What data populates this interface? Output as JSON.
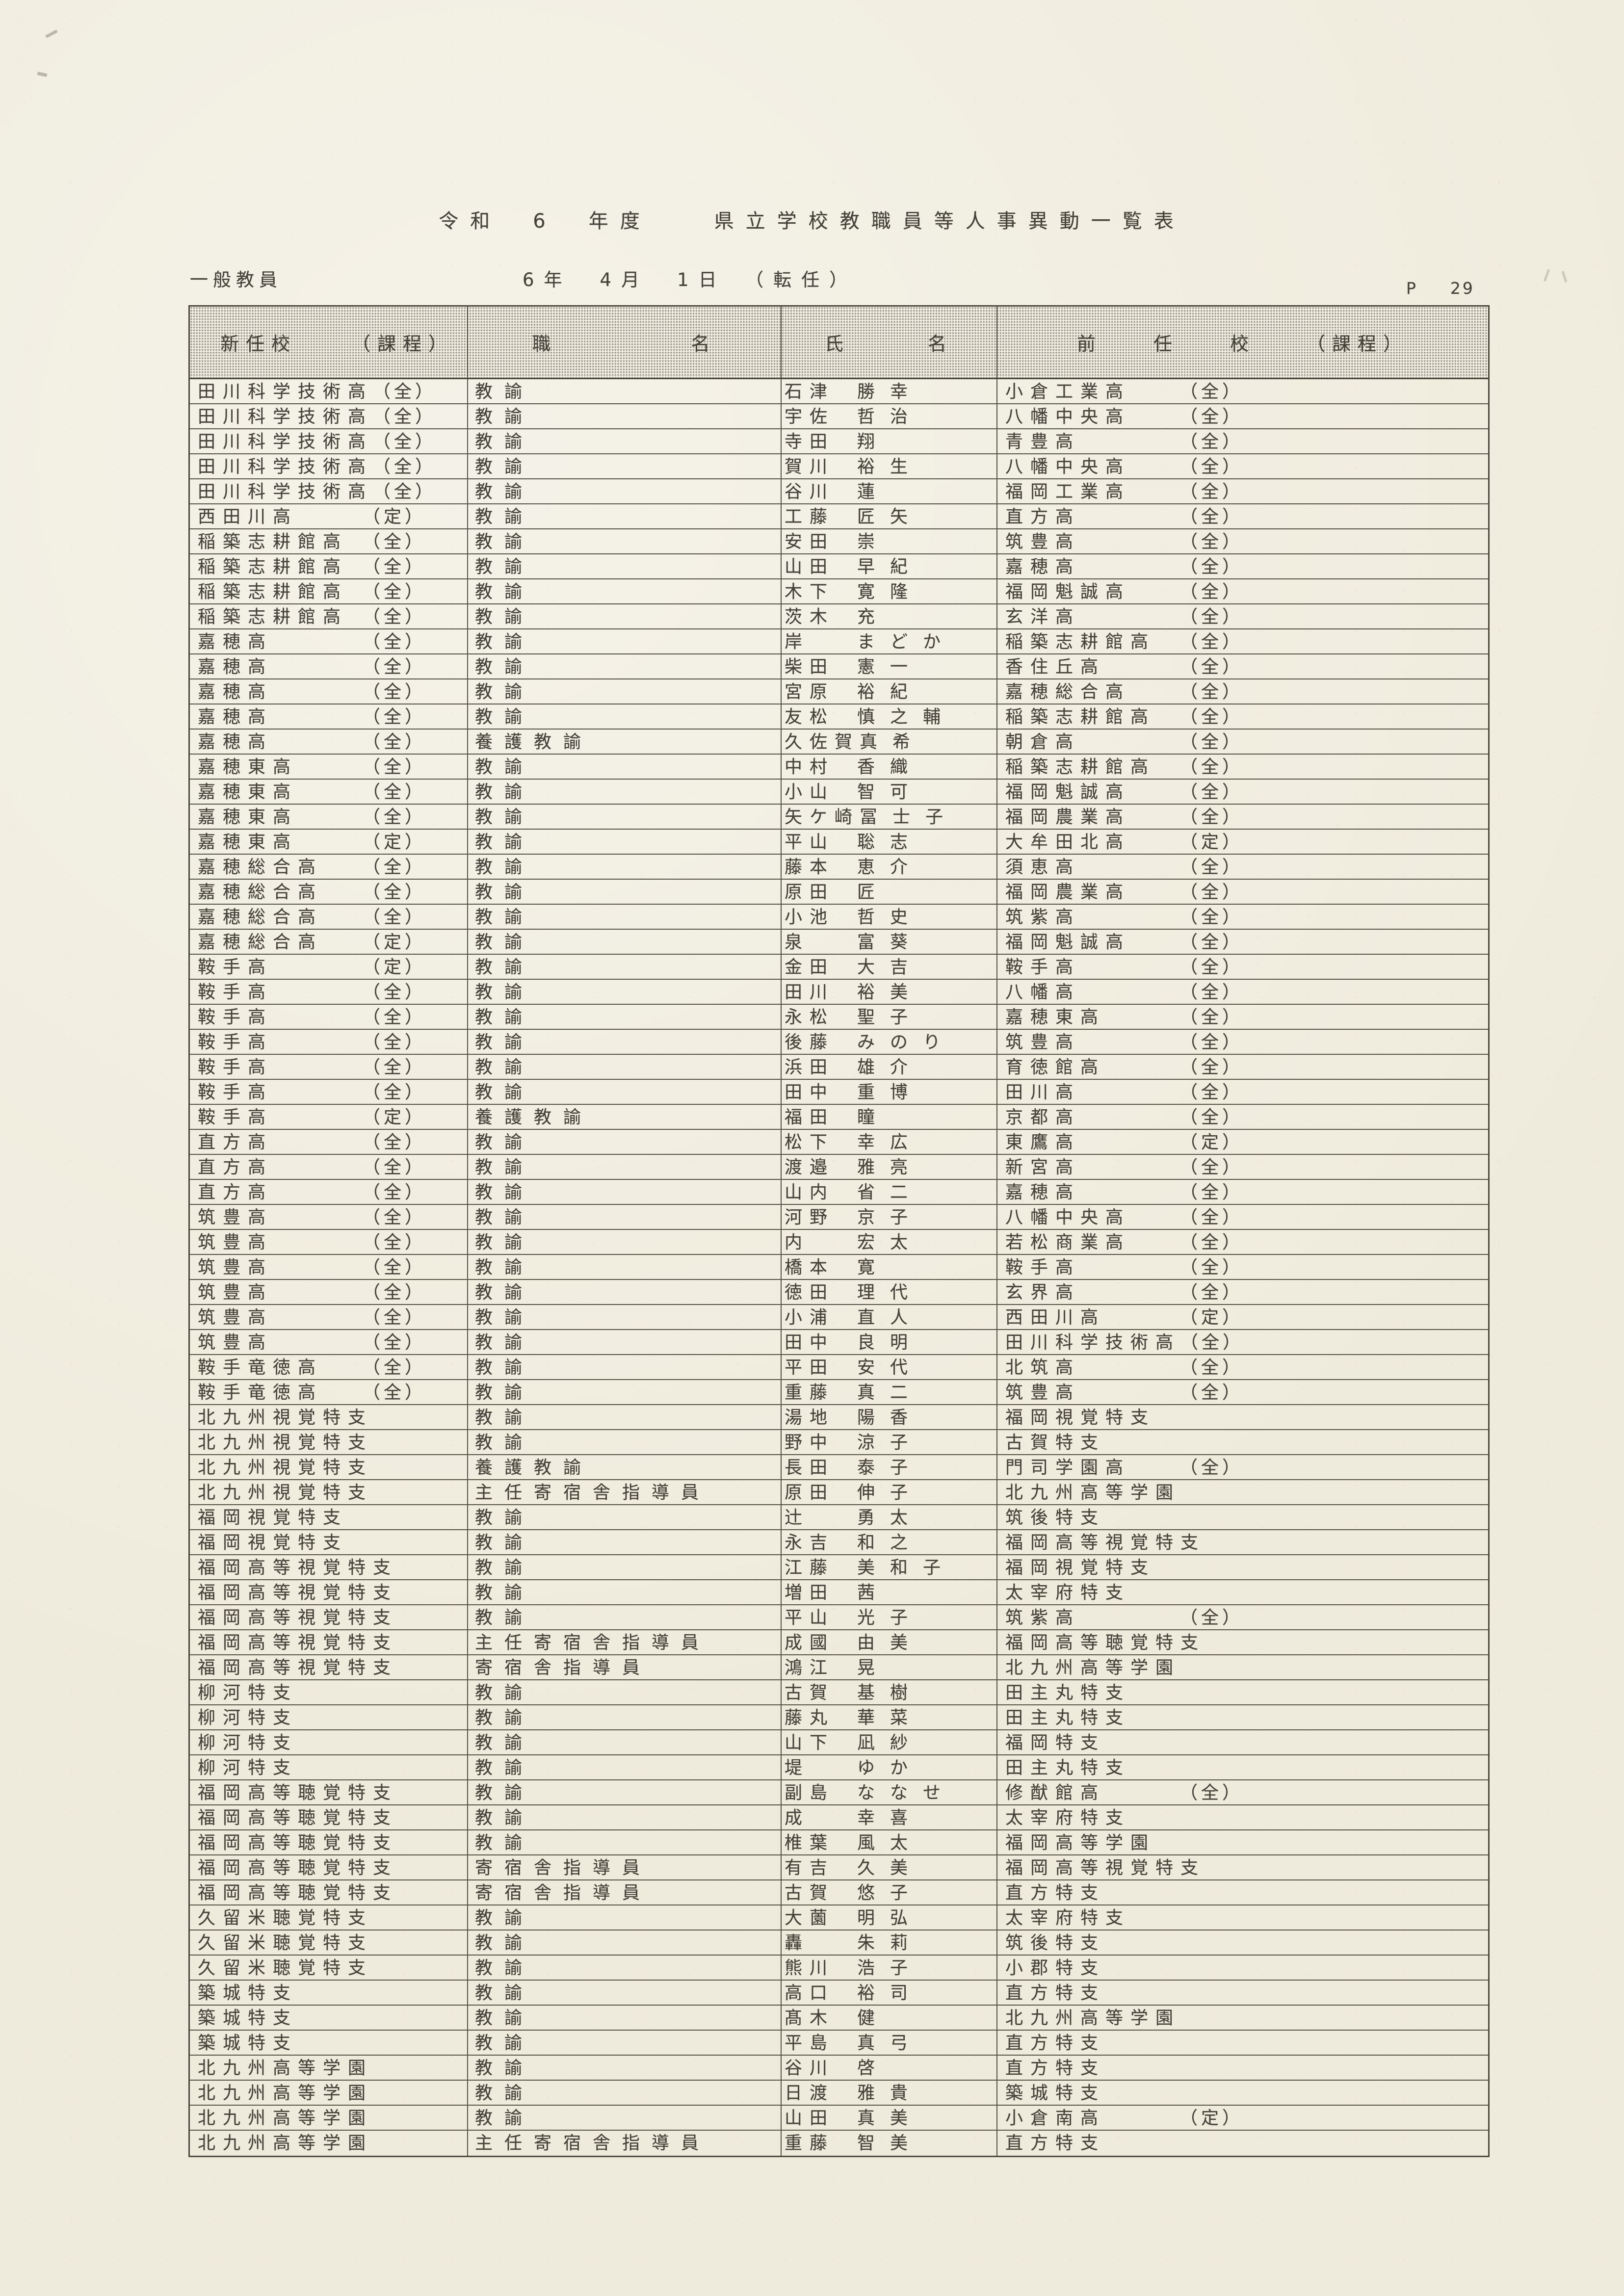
{
  "page": {
    "title": "令和　6　年度　　県立学校教職員等人事異動一覧表",
    "category_label": "一般教員",
    "date_line": "6年　4月　1日　（転任）",
    "page_marker": {
      "label": "P",
      "number": "29"
    }
  },
  "table": {
    "headers": {
      "col1": [
        "新任校",
        "（課程）"
      ],
      "col2": [
        "職",
        "名"
      ],
      "col3": [
        "氏",
        "名"
      ],
      "col4": [
        "前",
        "任",
        "校",
        "（課程）"
      ]
    },
    "rows": [
      {
        "school": "田川科学技術高",
        "course": "（全）",
        "position": "教諭",
        "name": "石津　勝幸",
        "prev_school": "小倉工業高",
        "prev_course": "（全）"
      },
      {
        "school": "田川科学技術高",
        "course": "（全）",
        "position": "教諭",
        "name": "宇佐　哲治",
        "prev_school": "八幡中央高",
        "prev_course": "（全）"
      },
      {
        "school": "田川科学技術高",
        "course": "（全）",
        "position": "教諭",
        "name": "寺田　翔",
        "prev_school": "青豊高",
        "prev_course": "（全）"
      },
      {
        "school": "田川科学技術高",
        "course": "（全）",
        "position": "教諭",
        "name": "賀川　裕生",
        "prev_school": "八幡中央高",
        "prev_course": "（全）"
      },
      {
        "school": "田川科学技術高",
        "course": "（全）",
        "position": "教諭",
        "name": "谷川　蓮",
        "prev_school": "福岡工業高",
        "prev_course": "（全）"
      },
      {
        "school": "西田川高",
        "course": "（定）",
        "position": "教諭",
        "name": "工藤　匠矢",
        "prev_school": "直方高",
        "prev_course": "（全）"
      },
      {
        "school": "稲築志耕館高",
        "course": "（全）",
        "position": "教諭",
        "name": "安田　崇",
        "prev_school": "筑豊高",
        "prev_course": "（全）"
      },
      {
        "school": "稲築志耕館高",
        "course": "（全）",
        "position": "教諭",
        "name": "山田　早紀",
        "prev_school": "嘉穂高",
        "prev_course": "（全）"
      },
      {
        "school": "稲築志耕館高",
        "course": "（全）",
        "position": "教諭",
        "name": "木下　寛隆",
        "prev_school": "福岡魁誠高",
        "prev_course": "（全）"
      },
      {
        "school": "稲築志耕館高",
        "course": "（全）",
        "position": "教諭",
        "name": "茨木　充",
        "prev_school": "玄洋高",
        "prev_course": "（全）"
      },
      {
        "school": "嘉穂高",
        "course": "（全）",
        "position": "教諭",
        "name": "岸　まどか",
        "prev_school": "稲築志耕館高",
        "prev_course": "（全）"
      },
      {
        "school": "嘉穂高",
        "course": "（全）",
        "position": "教諭",
        "name": "柴田　憲一",
        "prev_school": "香住丘高",
        "prev_course": "（全）"
      },
      {
        "school": "嘉穂高",
        "course": "（全）",
        "position": "教諭",
        "name": "宮原　裕紀",
        "prev_school": "嘉穂総合高",
        "prev_course": "（全）"
      },
      {
        "school": "嘉穂高",
        "course": "（全）",
        "position": "教諭",
        "name": "友松　慎之輔",
        "prev_school": "稲築志耕館高",
        "prev_course": "（全）"
      },
      {
        "school": "嘉穂高",
        "course": "（全）",
        "position": "養護教諭",
        "name": "久佐賀　真希",
        "prev_school": "朝倉高",
        "prev_course": "（全）"
      },
      {
        "school": "嘉穂東高",
        "course": "（全）",
        "position": "教諭",
        "name": "中村　香織",
        "prev_school": "稲築志耕館高",
        "prev_course": "（全）"
      },
      {
        "school": "嘉穂東高",
        "course": "（全）",
        "position": "教諭",
        "name": "小山　智可",
        "prev_school": "福岡魁誠高",
        "prev_course": "（全）"
      },
      {
        "school": "嘉穂東高",
        "course": "（全）",
        "position": "教諭",
        "name": "矢ケ崎　冨士子",
        "prev_school": "福岡農業高",
        "prev_course": "（全）"
      },
      {
        "school": "嘉穂東高",
        "course": "（定）",
        "position": "教諭",
        "name": "平山　聡志",
        "prev_school": "大牟田北高",
        "prev_course": "（定）"
      },
      {
        "school": "嘉穂総合高",
        "course": "（全）",
        "position": "教諭",
        "name": "藤本　恵介",
        "prev_school": "須恵高",
        "prev_course": "（全）"
      },
      {
        "school": "嘉穂総合高",
        "course": "（全）",
        "position": "教諭",
        "name": "原田　匠",
        "prev_school": "福岡農業高",
        "prev_course": "（全）"
      },
      {
        "school": "嘉穂総合高",
        "course": "（全）",
        "position": "教諭",
        "name": "小池　哲史",
        "prev_school": "筑紫高",
        "prev_course": "（全）"
      },
      {
        "school": "嘉穂総合高",
        "course": "（定）",
        "position": "教諭",
        "name": "泉　富葵",
        "prev_school": "福岡魁誠高",
        "prev_course": "（全）"
      },
      {
        "school": "鞍手高",
        "course": "（定）",
        "position": "教諭",
        "name": "金田　大吉",
        "prev_school": "鞍手高",
        "prev_course": "（全）"
      },
      {
        "school": "鞍手高",
        "course": "（全）",
        "position": "教諭",
        "name": "田川　裕美",
        "prev_school": "八幡高",
        "prev_course": "（全）"
      },
      {
        "school": "鞍手高",
        "course": "（全）",
        "position": "教諭",
        "name": "永松　聖子",
        "prev_school": "嘉穂東高",
        "prev_course": "（全）"
      },
      {
        "school": "鞍手高",
        "course": "（全）",
        "position": "教諭",
        "name": "後藤　みのり",
        "prev_school": "筑豊高",
        "prev_course": "（全）"
      },
      {
        "school": "鞍手高",
        "course": "（全）",
        "position": "教諭",
        "name": "浜田　雄介",
        "prev_school": "育徳館高",
        "prev_course": "（全）"
      },
      {
        "school": "鞍手高",
        "course": "（全）",
        "position": "教諭",
        "name": "田中　重博",
        "prev_school": "田川高",
        "prev_course": "（全）"
      },
      {
        "school": "鞍手高",
        "course": "（定）",
        "position": "養護教諭",
        "name": "福田　瞳",
        "prev_school": "京都高",
        "prev_course": "（全）"
      },
      {
        "school": "直方高",
        "course": "（全）",
        "position": "教諭",
        "name": "松下　幸広",
        "prev_school": "東鷹高",
        "prev_course": "（定）"
      },
      {
        "school": "直方高",
        "course": "（全）",
        "position": "教諭",
        "name": "渡邉　雅亮",
        "prev_school": "新宮高",
        "prev_course": "（全）"
      },
      {
        "school": "直方高",
        "course": "（全）",
        "position": "教諭",
        "name": "山内　省二",
        "prev_school": "嘉穂高",
        "prev_course": "（全）"
      },
      {
        "school": "筑豊高",
        "course": "（全）",
        "position": "教諭",
        "name": "河野　京子",
        "prev_school": "八幡中央高",
        "prev_course": "（全）"
      },
      {
        "school": "筑豊高",
        "course": "（全）",
        "position": "教諭",
        "name": "内　宏太",
        "prev_school": "若松商業高",
        "prev_course": "（全）"
      },
      {
        "school": "筑豊高",
        "course": "（全）",
        "position": "教諭",
        "name": "橋本　寛",
        "prev_school": "鞍手高",
        "prev_course": "（全）"
      },
      {
        "school": "筑豊高",
        "course": "（全）",
        "position": "教諭",
        "name": "徳田　理代",
        "prev_school": "玄界高",
        "prev_course": "（全）"
      },
      {
        "school": "筑豊高",
        "course": "（全）",
        "position": "教諭",
        "name": "小浦　直人",
        "prev_school": "西田川高",
        "prev_course": "（定）"
      },
      {
        "school": "筑豊高",
        "course": "（全）",
        "position": "教諭",
        "name": "田中　良明",
        "prev_school": "田川科学技術高",
        "prev_course": "（全）"
      },
      {
        "school": "鞍手竜徳高",
        "course": "（全）",
        "position": "教諭",
        "name": "平田　安代",
        "prev_school": "北筑高",
        "prev_course": "（全）"
      },
      {
        "school": "鞍手竜徳高",
        "course": "（全）",
        "position": "教諭",
        "name": "重藤　真二",
        "prev_school": "筑豊高",
        "prev_course": "（全）"
      },
      {
        "school": "北九州視覚特支",
        "course": "",
        "position": "教諭",
        "name": "湯地　陽香",
        "prev_school": "福岡視覚特支",
        "prev_course": ""
      },
      {
        "school": "北九州視覚特支",
        "course": "",
        "position": "教諭",
        "name": "野中　涼子",
        "prev_school": "古賀特支",
        "prev_course": ""
      },
      {
        "school": "北九州視覚特支",
        "course": "",
        "position": "養護教諭",
        "name": "長田　泰子",
        "prev_school": "門司学園高",
        "prev_course": "（全）"
      },
      {
        "school": "北九州視覚特支",
        "course": "",
        "position": "主任寄宿舎指導員",
        "name": "原田　伸子",
        "prev_school": "北九州高等学園",
        "prev_course": ""
      },
      {
        "school": "福岡視覚特支",
        "course": "",
        "position": "教諭",
        "name": "辻　勇太",
        "prev_school": "筑後特支",
        "prev_course": ""
      },
      {
        "school": "福岡視覚特支",
        "course": "",
        "position": "教諭",
        "name": "永吉　和之",
        "prev_school": "福岡高等視覚特支",
        "prev_course": ""
      },
      {
        "school": "福岡高等視覚特支",
        "course": "",
        "position": "教諭",
        "name": "江藤　美和子",
        "prev_school": "福岡視覚特支",
        "prev_course": ""
      },
      {
        "school": "福岡高等視覚特支",
        "course": "",
        "position": "教諭",
        "name": "増田　茜",
        "prev_school": "太宰府特支",
        "prev_course": ""
      },
      {
        "school": "福岡高等視覚特支",
        "course": "",
        "position": "教諭",
        "name": "平山　光子",
        "prev_school": "筑紫高",
        "prev_course": "（全）"
      },
      {
        "school": "福岡高等視覚特支",
        "course": "",
        "position": "主任寄宿舎指導員",
        "name": "成國　由美",
        "prev_school": "福岡高等聴覚特支",
        "prev_course": ""
      },
      {
        "school": "福岡高等視覚特支",
        "course": "",
        "position": "寄宿舎指導員",
        "name": "鴻江　晃",
        "prev_school": "北九州高等学園",
        "prev_course": ""
      },
      {
        "school": "柳河特支",
        "course": "",
        "position": "教諭",
        "name": "古賀　基樹",
        "prev_school": "田主丸特支",
        "prev_course": ""
      },
      {
        "school": "柳河特支",
        "course": "",
        "position": "教諭",
        "name": "藤丸　華菜",
        "prev_school": "田主丸特支",
        "prev_course": ""
      },
      {
        "school": "柳河特支",
        "course": "",
        "position": "教諭",
        "name": "山下　凪紗",
        "prev_school": "福岡特支",
        "prev_course": ""
      },
      {
        "school": "柳河特支",
        "course": "",
        "position": "教諭",
        "name": "堤　ゆか",
        "prev_school": "田主丸特支",
        "prev_course": ""
      },
      {
        "school": "福岡高等聴覚特支",
        "course": "",
        "position": "教諭",
        "name": "副島　ななせ",
        "prev_school": "修猷館高",
        "prev_course": "（全）"
      },
      {
        "school": "福岡高等聴覚特支",
        "course": "",
        "position": "教諭",
        "name": "成　幸喜",
        "prev_school": "太宰府特支",
        "prev_course": ""
      },
      {
        "school": "福岡高等聴覚特支",
        "course": "",
        "position": "教諭",
        "name": "椎葉　風太",
        "prev_school": "福岡高等学園",
        "prev_course": ""
      },
      {
        "school": "福岡高等聴覚特支",
        "course": "",
        "position": "寄宿舎指導員",
        "name": "有吉　久美",
        "prev_school": "福岡高等視覚特支",
        "prev_course": ""
      },
      {
        "school": "福岡高等聴覚特支",
        "course": "",
        "position": "寄宿舎指導員",
        "name": "古賀　悠子",
        "prev_school": "直方特支",
        "prev_course": ""
      },
      {
        "school": "久留米聴覚特支",
        "course": "",
        "position": "教諭",
        "name": "大薗　明弘",
        "prev_school": "太宰府特支",
        "prev_course": ""
      },
      {
        "school": "久留米聴覚特支",
        "course": "",
        "position": "教諭",
        "name": "轟　朱莉",
        "prev_school": "筑後特支",
        "prev_course": ""
      },
      {
        "school": "久留米聴覚特支",
        "course": "",
        "position": "教諭",
        "name": "熊川　浩子",
        "prev_school": "小郡特支",
        "prev_course": ""
      },
      {
        "school": "築城特支",
        "course": "",
        "position": "教諭",
        "name": "高口　裕司",
        "prev_school": "直方特支",
        "prev_course": ""
      },
      {
        "school": "築城特支",
        "course": "",
        "position": "教諭",
        "name": "髙木　健",
        "prev_school": "北九州高等学園",
        "prev_course": ""
      },
      {
        "school": "築城特支",
        "course": "",
        "position": "教諭",
        "name": "平島　真弓",
        "prev_school": "直方特支",
        "prev_course": ""
      },
      {
        "school": "北九州高等学園",
        "course": "",
        "position": "教諭",
        "name": "谷川　啓",
        "prev_school": "直方特支",
        "prev_course": ""
      },
      {
        "school": "北九州高等学園",
        "course": "",
        "position": "教諭",
        "name": "日渡　雅貴",
        "prev_school": "築城特支",
        "prev_course": ""
      },
      {
        "school": "北九州高等学園",
        "course": "",
        "position": "教諭",
        "name": "山田　真美",
        "prev_school": "小倉南高",
        "prev_course": "（定）"
      },
      {
        "school": "北九州高等学園",
        "course": "",
        "position": "主任寄宿舎指導員",
        "name": "重藤　智美",
        "prev_school": "直方特支",
        "prev_course": ""
      }
    ]
  }
}
